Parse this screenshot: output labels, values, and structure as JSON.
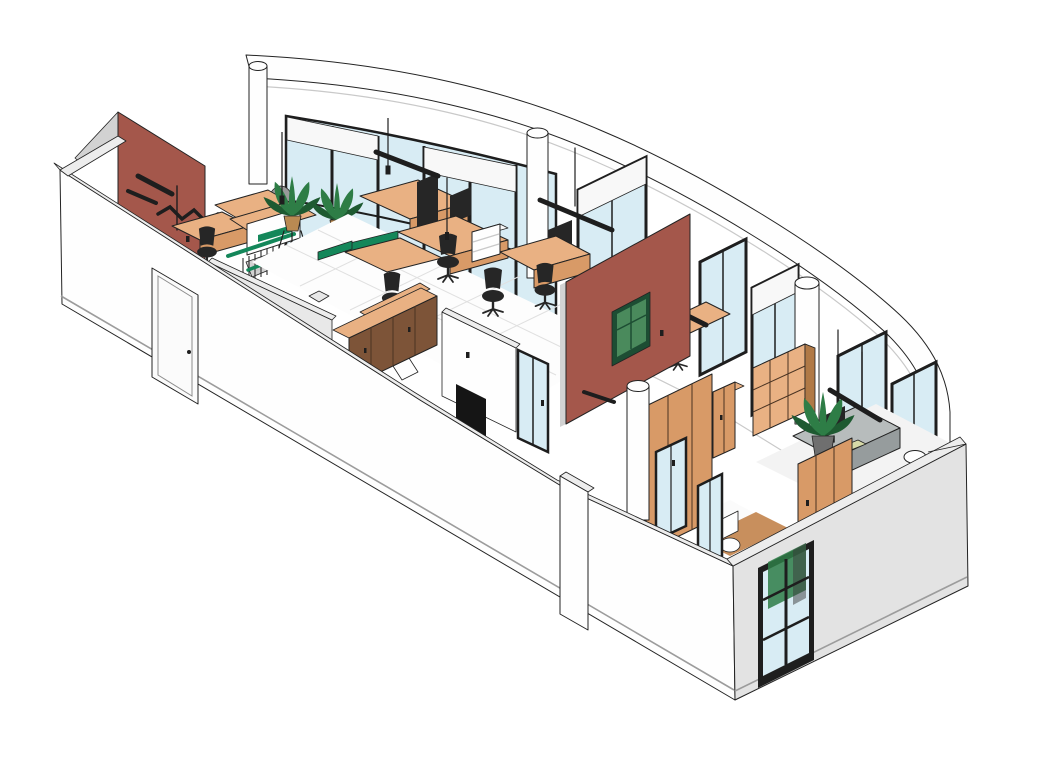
{
  "scene": {
    "type": "3d-axonometric-office-floor-cutaway",
    "objects": [
      "curved-parapet",
      "curtain-wall-glazing",
      "roller-shades",
      "punched-windows",
      "structural-columns",
      "red-accent-wall-left",
      "red-accent-wall-center",
      "green-wall-art",
      "coat-rack",
      "reception-desk",
      "staircase",
      "green-handrail",
      "potted-plants",
      "office-desks",
      "desk-partitions",
      "drawer-units",
      "office-chairs",
      "ceiling-light-tracks",
      "pendant-lights",
      "wood-lockers",
      "wood-shelving",
      "wardrobe",
      "executive-desk",
      "monitor",
      "keyboard-pad",
      "round-stool",
      "glass-doors",
      "dark-doorway",
      "ottoman",
      "toilet",
      "wood-panel-walls",
      "wood-floor-patch",
      "tile-floor",
      "exterior-door",
      "exterior-window",
      "front-cut-walls",
      "gray-exterior-wall",
      "wall-pillar"
    ]
  },
  "palette": {
    "background": "#ffffff",
    "outline": "#232323",
    "line_soft": "#c9c9c9",
    "baseboard": "#9c9c9c",
    "wall_white": "#fefefe",
    "wall_cap": "#ededed",
    "wall_inner_gray": "#e8e8e8",
    "wall_side_dark": "#d2d2d2",
    "wall_gray_ext": "#e3e3e3",
    "accent_red": "#a4574b",
    "green_accent": "#14875a",
    "green_art": "#4a8a5c",
    "green_art_dark": "#1d4d33",
    "glass": "#d8ecf4",
    "frame_dark": "#1e1e1e",
    "shade": "#f8f8f8",
    "wood_light": "#e9b183",
    "wood_mid": "#d89a67",
    "wood_front": "#7d5438",
    "wood_dark": "#b07946",
    "wood_seam": "#4a3322",
    "wood_floor": "#c88f5d",
    "floor": "#fdfdfd",
    "floor_grid": "#e0e0e0",
    "chair": "#262626",
    "desk_gray": "#b7bcbc",
    "desk_gray_dark": "#969c9d",
    "plant": "#2e7d46",
    "plant_dark": "#1e5a31",
    "pot": "#b98a52",
    "pot_gray": "#6f6f6f",
    "sculpture": "#999999",
    "keyboard_pad": "#d6d9a8",
    "door_white": "#fbfbfb"
  }
}
